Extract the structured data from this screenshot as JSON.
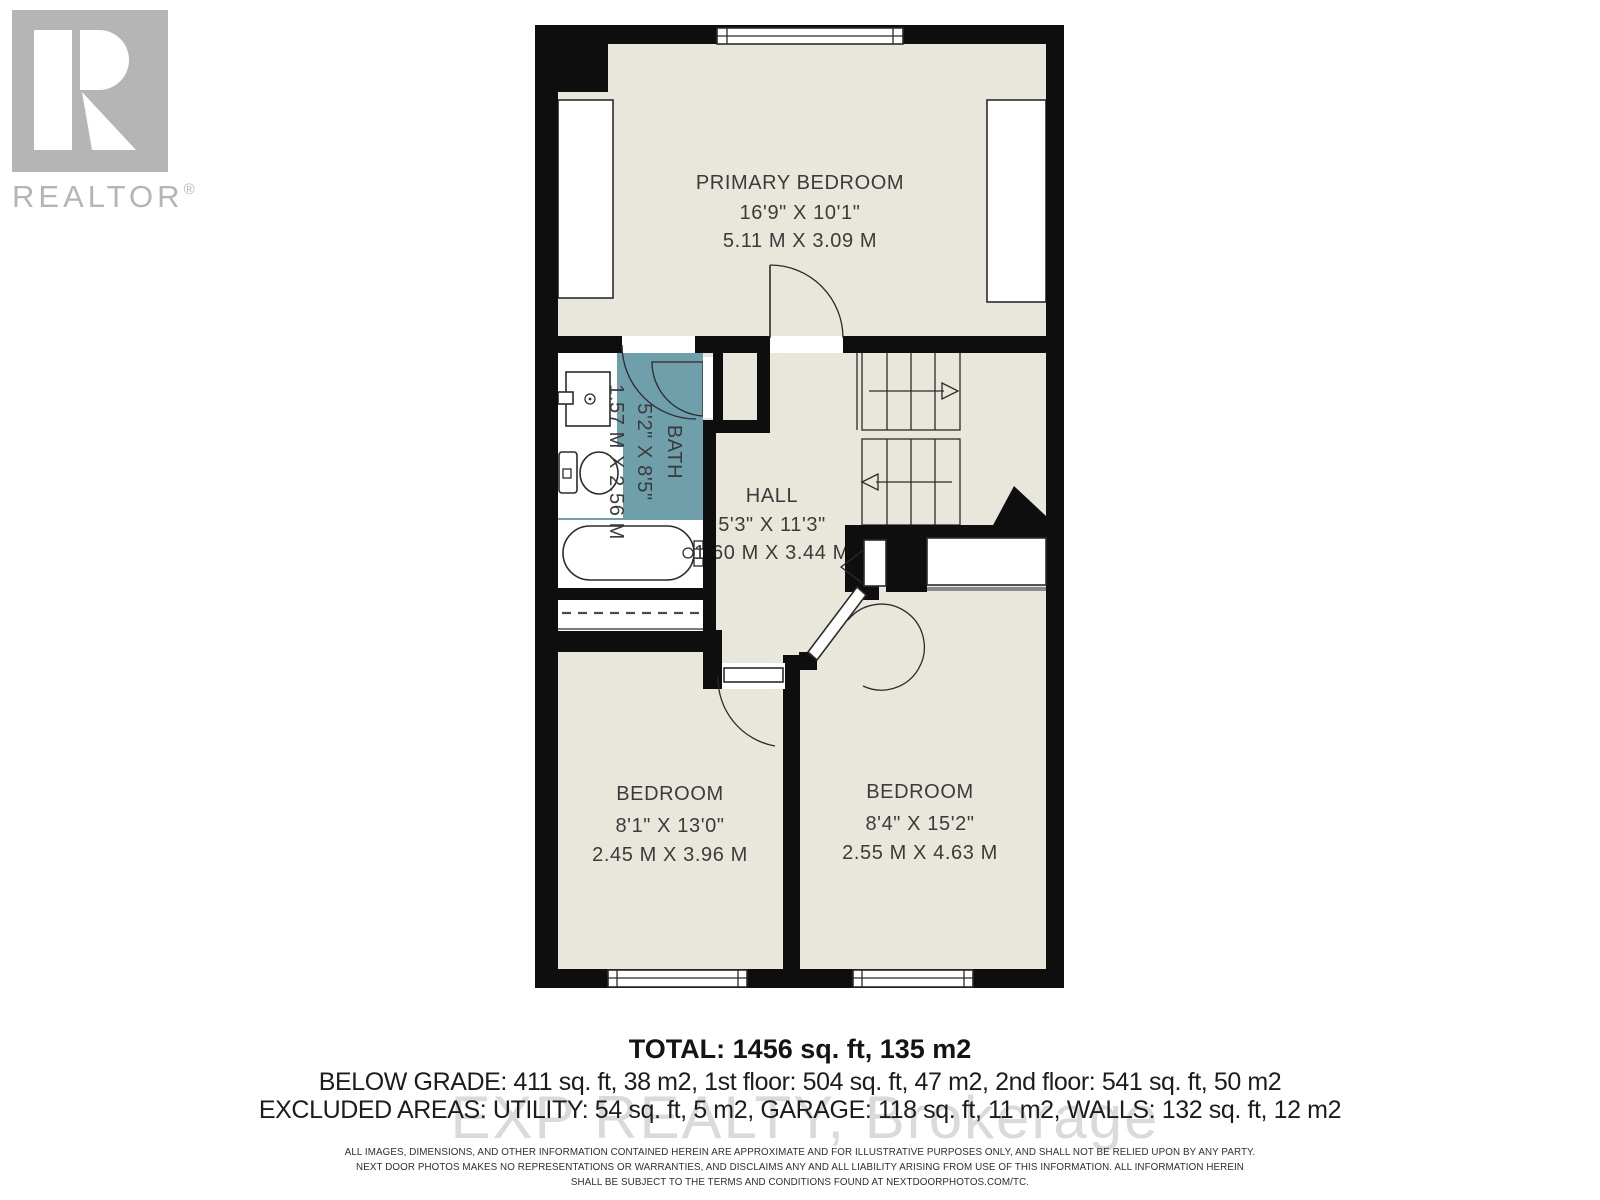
{
  "branding": {
    "realtor_logo": "REALTOR",
    "registered_mark": "®"
  },
  "floorplan": {
    "rooms": {
      "primary_bedroom": {
        "name": "PRIMARY BEDROOM",
        "imperial": "16'9\" X 10'1\"",
        "metric": "5.11 M X 3.09 M"
      },
      "bath": {
        "name": "BATH",
        "imperial": "5'2\" X 8'5\"",
        "metric": "1.57 M X 2.56 M"
      },
      "hall": {
        "name": "HALL",
        "imperial": "5'3\" X 11'3\"",
        "metric": "1.60 M X 3.44 M"
      },
      "bedroom_left": {
        "name": "BEDROOM",
        "imperial": "8'1\" X 13'0\"",
        "metric": "2.45 M X 3.96 M"
      },
      "bedroom_right": {
        "name": "BEDROOM",
        "imperial": "8'4\" X 15'2\"",
        "metric": "2.55 M X 4.63 M"
      }
    }
  },
  "area_summary": {
    "total": "TOTAL: 1456 sq. ft, 135 m2",
    "below_grade_line": "BELOW GRADE: 411 sq. ft, 38 m2, 1st floor: 504 sq. ft, 47 m2, 2nd floor: 541 sq. ft, 50 m2",
    "excluded_line": "EXCLUDED AREAS: UTILITY: 54 sq. ft, 5 m2, GARAGE: 118 sq. ft, 11 m2, WALLS: 132 sq. ft, 12 m2"
  },
  "watermark": "EXP REALTY, Brokerage",
  "disclaimer": {
    "line1": "ALL IMAGES, DIMENSIONS, AND OTHER INFORMATION CONTAINED HEREIN ARE APPROXIMATE AND FOR ILLUSTRATIVE PURPOSES ONLY, AND SHALL NOT BE RELIED UPON BY ANY PARTY.",
    "line2": "NEXT DOOR PHOTOS MAKES NO REPRESENTATIONS OR WARRANTIES, AND DISCLAIMS ANY AND ALL LIABILITY ARISING FROM USE OF THIS INFORMATION. ALL INFORMATION HEREIN",
    "line3": "SHALL BE SUBJECT TO THE TERMS AND CONDITIONS FOUND AT NEXTDOORPHOTOS.COM/TC."
  },
  "colors": {
    "floor_fill": "#e9e7dc",
    "bath_fill": "#6f9fab",
    "wall_fill": "#0e0e0e",
    "logo_gray": "#b5b5b5",
    "watermark_gray": "#d6d6d6"
  }
}
